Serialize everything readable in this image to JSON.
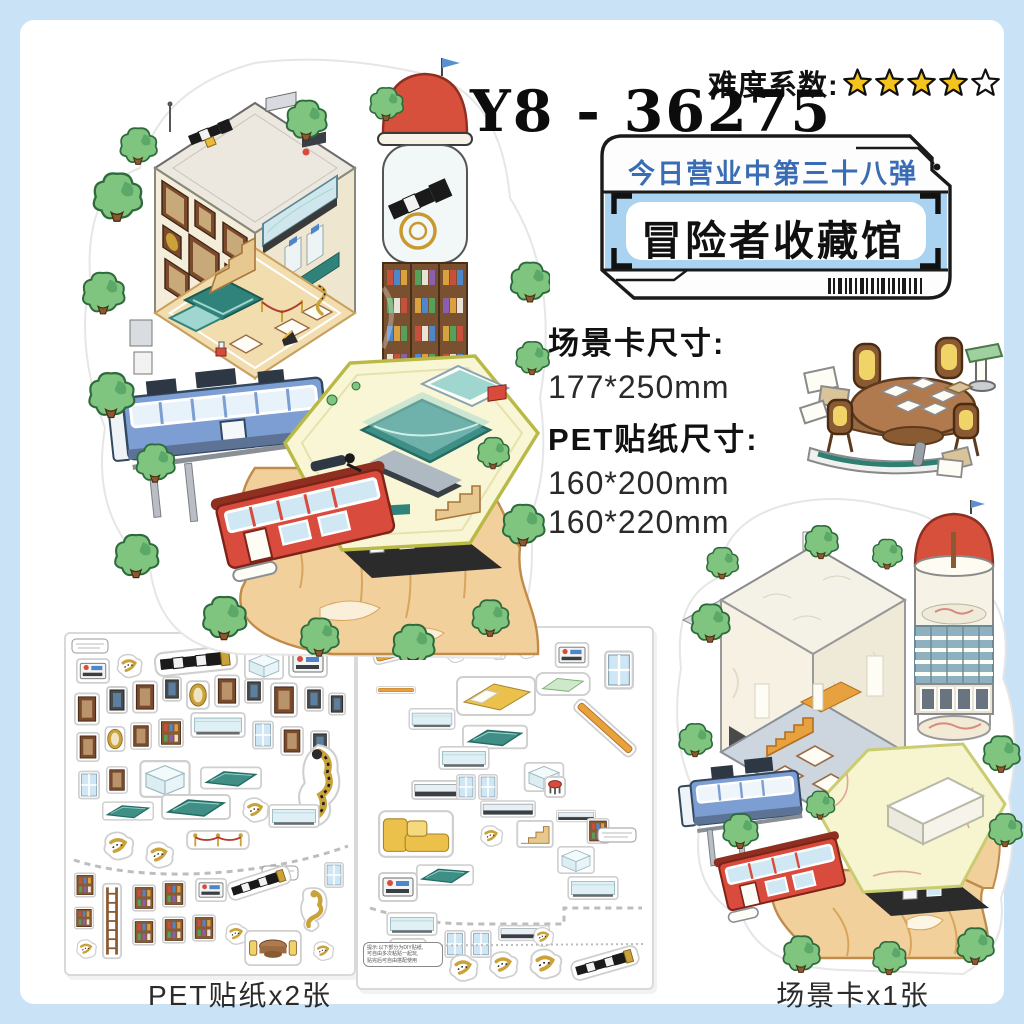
{
  "colors": {
    "frame_blue": "#c9e2f6",
    "star_gold": "#f5c31d",
    "badge_text_blue": "#3a6cb4",
    "badge_band_blue": "#a9d3f0",
    "dome_red": "#d7503b",
    "bus_blue": "#7d9ed2",
    "cabin_red": "#d94b3c",
    "cliff_tan": "#f2d09c",
    "leaf_green": "#7fc47f"
  },
  "header": {
    "difficulty_label": "难度系数:",
    "stars_total": 5,
    "stars_filled": 4,
    "star_icon": "star-icon",
    "product_code": "Y8 - 36275"
  },
  "badge": {
    "line1": "今日营业中第三十八弹",
    "line2": "冒险者收藏馆",
    "barcode_icon": "barcode-icon"
  },
  "specs": {
    "scene_card_size_label": "场景卡尺寸:",
    "scene_card_size": "177*250mm",
    "pet_size_label": "PET贴纸尺寸:",
    "pet_sizes": [
      "160*200mm",
      "160*220mm"
    ]
  },
  "footer": {
    "pet_sheets_label": "PET贴纸x2张",
    "scene_card_label": "场景卡x1张"
  },
  "note": {
    "line1": "提示:以下部分为DIY贴纸,",
    "line2": "可自由多次粘贴一起玩,",
    "line3": "贴完后可自由搭配使用"
  }
}
